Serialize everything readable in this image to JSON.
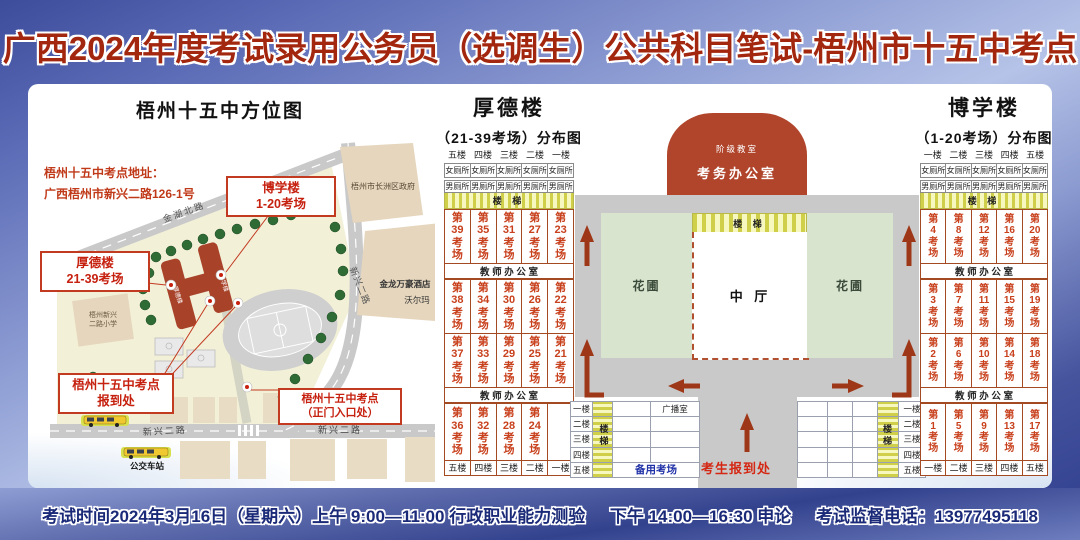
{
  "title": "广西2024年度考试录用公务员（选调生）公共科目笔试-梧州市十五中考点",
  "footer": {
    "session1": "考试时间2024年3月16日（星期六）上午 9:00—11:00 行政职业能力测验",
    "session2": "下午 14:00—16:30 申论",
    "phone": "考试监督电话：13977495118"
  },
  "map": {
    "title": "梧州十五中方位图",
    "address_line1": "梧州十五中考点地址：",
    "address_line2": "广西梧州市新兴二路126-1号",
    "callouts": {
      "boxue": "博学楼\n1-20考场",
      "houde": "厚德楼\n21-39考场",
      "checkin": "梧州十五中考点\n报到处",
      "gate": "梧州十五中考点\n（正门入口处）"
    },
    "roads": {
      "jinhu_north": "金湖北路",
      "xinxing_right": "新兴二路",
      "xinxing_bottom_left": "新兴二路",
      "xinxing_bottom_right": "新兴二路"
    },
    "places": {
      "government": "梧州市长洲区政府",
      "hotel": "金龙万豪酒店",
      "walmart": "沃尔玛",
      "primary_school_line1": "梧州新兴",
      "primary_school_line2": "二路小学",
      "bus_station_1": "公交车站",
      "bus_station_2": "公交车站",
      "houde_building": "厚德楼",
      "boxue_building": "博学楼"
    }
  },
  "labels": {
    "female_toilet": "女厕所",
    "male_toilet": "男厕所",
    "stairs_h": "楼 梯",
    "stairs_v": "楼\n梯",
    "office": "教 师 办 公 室"
  },
  "houde": {
    "name": "厚德楼",
    "subtitle": "（21-39考场）分布图",
    "floors_top": [
      "五楼",
      "四楼",
      "三楼",
      "二楼",
      "一楼"
    ],
    "floors_bottom": [
      "五楼",
      "四楼",
      "三楼",
      "二楼",
      "一楼"
    ],
    "rows": [
      [
        "第\n39\n考\n场",
        "第\n35\n考\n场",
        "第\n31\n考\n场",
        "第\n27\n考\n场",
        "第\n23\n考\n场"
      ],
      [
        "第\n38\n考\n场",
        "第\n34\n考\n场",
        "第\n30\n考\n场",
        "第\n26\n考\n场",
        "第\n22\n考\n场"
      ],
      [
        "第\n37\n考\n场",
        "第\n33\n考\n场",
        "第\n29\n考\n场",
        "第\n25\n考\n场",
        "第\n21\n考\n场"
      ],
      [
        "第\n36\n考\n场",
        "第\n32\n考\n场",
        "第\n28\n考\n场",
        "第\n24\n考\n场",
        ""
      ]
    ]
  },
  "boxue": {
    "name": "博学楼",
    "subtitle": "（1-20考场）分布图",
    "floors_top": [
      "一楼",
      "二楼",
      "三楼",
      "四楼",
      "五楼"
    ],
    "floors_bottom": [
      "一楼",
      "二楼",
      "三楼",
      "四楼",
      "五楼"
    ],
    "rows": [
      [
        "第\n4\n考\n场",
        "第\n8\n考\n场",
        "第\n12\n考\n场",
        "第\n16\n考\n场",
        "第\n20\n考\n场"
      ],
      [
        "第\n3\n考\n场",
        "第\n7\n考\n场",
        "第\n11\n考\n场",
        "第\n15\n考\n场",
        "第\n19\n考\n场"
      ],
      [
        "第\n2\n考\n场",
        "第\n6\n考\n场",
        "第\n10\n考\n场",
        "第\n14\n考\n场",
        "第\n18\n考\n场"
      ],
      [
        "第\n1\n考\n场",
        "第\n5\n考\n场",
        "第\n9\n考\n场",
        "第\n13\n考\n场",
        "第\n17\n考\n场"
      ]
    ]
  },
  "center": {
    "lecture_hall": "阶级教室",
    "exam_office": "考务办公室",
    "hall": "中 厅",
    "garden_left": "花圃",
    "garden_right": "花圃",
    "checkin": "考生报到处",
    "left_annex": {
      "floors": [
        "一楼",
        "二楼",
        "三楼",
        "四楼",
        "五楼"
      ],
      "broadcast": "广播室",
      "backup": "备用考场"
    },
    "right_annex": {
      "floors": [
        "一楼",
        "二楼",
        "三楼",
        "四楼",
        "五楼"
      ]
    }
  },
  "colors": {
    "accent_red": "#a3260e",
    "building_red": "#b0452c",
    "exam_text": "#c8401c",
    "garden_green": "#d9e4cf",
    "road_gray": "#c9c9c9",
    "footer_navy": "#1b2a78"
  }
}
